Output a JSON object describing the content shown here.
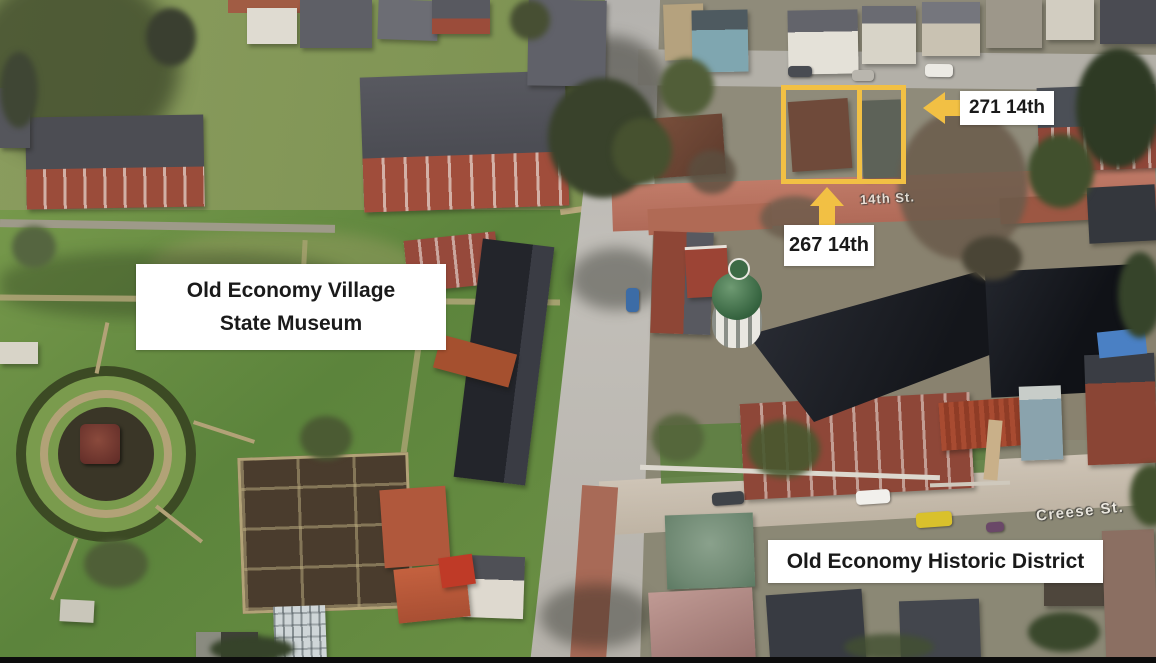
{
  "annotations": {
    "museum": {
      "line1": "Old Economy Village",
      "line2": "State Museum"
    },
    "district": {
      "label": "Old Economy Historic District"
    },
    "parcel_271": {
      "label": "271 14th"
    },
    "parcel_267": {
      "label": "267 14th"
    }
  },
  "street_labels": {
    "fourteenth": "14th St.",
    "creese": "Creese St."
  },
  "colors": {
    "annotation_highlight": "#F2C044",
    "annotation_label_bg": "#FFFFFF",
    "annotation_label_text": "#1A1A1A",
    "church_dome_green": "#35633F"
  }
}
